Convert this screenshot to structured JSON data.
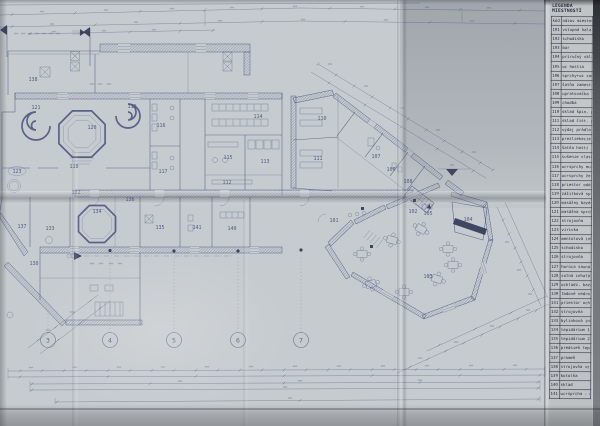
{
  "colors": {
    "paper": "#c6cbcf",
    "paper_shadow": "#b2b6ba",
    "ink": "#46517e",
    "ink_dark": "#2c3353",
    "legend_paper": "#c2c6c9",
    "legend_ink": "#262d3b",
    "photo_dark": "#43464a"
  },
  "legend": {
    "title": "LEGENDA MIESTNOSTÍ",
    "header": {
      "code": "kód",
      "name": "názov miestnosti"
    },
    "rows": [
      {
        "code": "101",
        "name": "vstupná hala"
      },
      {
        "code": "102",
        "name": "schodisko"
      },
      {
        "code": "103",
        "name": "bar"
      },
      {
        "code": "104",
        "name": "príručný sklad"
      },
      {
        "code": "105",
        "name": "wc hostia"
      },
      {
        "code": "106",
        "name": "sprchy+wc zamestn."
      },
      {
        "code": "107",
        "name": "šatňa zamestnancov"
      },
      {
        "code": "108",
        "name": "upratovačka"
      },
      {
        "code": "109",
        "name": "chodba"
      },
      {
        "code": "110",
        "name": "sklad špin. prádla"
      },
      {
        "code": "111",
        "name": "sklad čist. prádla"
      },
      {
        "code": "112",
        "name": "výdaj prádla"
      },
      {
        "code": "113",
        "name": "prezliekacie kab."
      },
      {
        "code": "114",
        "name": "šatňa hostí"
      },
      {
        "code": "115",
        "name": "sušenie vlasov"
      },
      {
        "code": "116",
        "name": "wc+sprchy muži"
      },
      {
        "code": "117",
        "name": "wc+sprchy ženy"
      },
      {
        "code": "118",
        "name": "priestor oddychu"
      },
      {
        "code": "119",
        "name": "zážitková sprcha"
      },
      {
        "code": "120",
        "name": "masážny bazén"
      },
      {
        "code": "121",
        "name": "masážna sprcha"
      },
      {
        "code": "122",
        "name": "strojovňa"
      },
      {
        "code": "123",
        "name": "vírivka"
      },
      {
        "code": "124",
        "name": "mentolová inhal."
      },
      {
        "code": "125",
        "name": "schodisko"
      },
      {
        "code": "126",
        "name": "strojovňa"
      },
      {
        "code": "127",
        "name": "horúca sauna"
      },
      {
        "code": "128",
        "name": "soľná inhalácia"
      },
      {
        "code": "129",
        "name": "ochladz. bazén"
      },
      {
        "code": "130",
        "name": "ľadové vedro"
      },
      {
        "code": "131",
        "name": "priestor ochladenia"
      },
      {
        "code": "132",
        "name": "strojovňa"
      },
      {
        "code": "133",
        "name": "bylinková inhal."
      },
      {
        "code": "134",
        "name": "tepidárium 1"
      },
      {
        "code": "135",
        "name": "tepidárium 2"
      },
      {
        "code": "136",
        "name": "predsieň tepidária"
      },
      {
        "code": "137",
        "name": "prameň"
      },
      {
        "code": "138",
        "name": "strojovňa vzt"
      },
      {
        "code": "139",
        "name": "kotolňa"
      },
      {
        "code": "140",
        "name": "sklad"
      },
      {
        "code": "141",
        "name": "wc+sprcha - muži"
      }
    ]
  },
  "plan": {
    "room_labels": [
      {
        "id": "138",
        "x": 33,
        "y": 81
      },
      {
        "id": "121",
        "x": 36,
        "y": 109
      },
      {
        "id": "119",
        "x": 132,
        "y": 108
      },
      {
        "id": "120",
        "x": 92,
        "y": 129
      },
      {
        "id": "116",
        "x": 161,
        "y": 127
      },
      {
        "id": "114",
        "x": 258,
        "y": 118
      },
      {
        "id": "123",
        "x": 17,
        "y": 173
      },
      {
        "id": "118",
        "x": 74,
        "y": 168
      },
      {
        "id": "115",
        "x": 228,
        "y": 159
      },
      {
        "id": "113",
        "x": 265,
        "y": 163
      },
      {
        "id": "117",
        "x": 163,
        "y": 173
      },
      {
        "id": "112",
        "x": 227,
        "y": 184
      },
      {
        "id": "132",
        "x": 76,
        "y": 194
      },
      {
        "id": "136",
        "x": 130,
        "y": 201
      },
      {
        "id": "134",
        "x": 97,
        "y": 213
      },
      {
        "id": "133",
        "x": 50,
        "y": 230
      },
      {
        "id": "137",
        "x": 22,
        "y": 228
      },
      {
        "id": "135",
        "x": 160,
        "y": 229
      },
      {
        "id": "141",
        "x": 197,
        "y": 229
      },
      {
        "id": "140",
        "x": 232,
        "y": 230
      },
      {
        "id": "130",
        "x": 34,
        "y": 265
      },
      {
        "id": "110",
        "x": 322,
        "y": 120
      },
      {
        "id": "111",
        "x": 318,
        "y": 160
      },
      {
        "id": "107",
        "x": 376,
        "y": 158
      },
      {
        "id": "106",
        "x": 391,
        "y": 171
      },
      {
        "id": "108",
        "x": 408,
        "y": 183
      },
      {
        "id": "101",
        "x": 334,
        "y": 222
      },
      {
        "id": "102",
        "x": 413,
        "y": 213
      },
      {
        "id": "105",
        "x": 428,
        "y": 215
      },
      {
        "id": "104",
        "x": 468,
        "y": 221
      },
      {
        "id": "103",
        "x": 428,
        "y": 278
      }
    ],
    "grid_axis_y": 340,
    "grid_axes": [
      {
        "n": "3",
        "x": 48,
        "line_top": 308
      },
      {
        "n": "4",
        "x": 110,
        "line_top": 258
      },
      {
        "n": "5",
        "x": 174,
        "line_top": 257
      },
      {
        "n": "6",
        "x": 238,
        "line_top": 257
      },
      {
        "n": "7",
        "x": 301,
        "line_top": 255
      }
    ]
  }
}
